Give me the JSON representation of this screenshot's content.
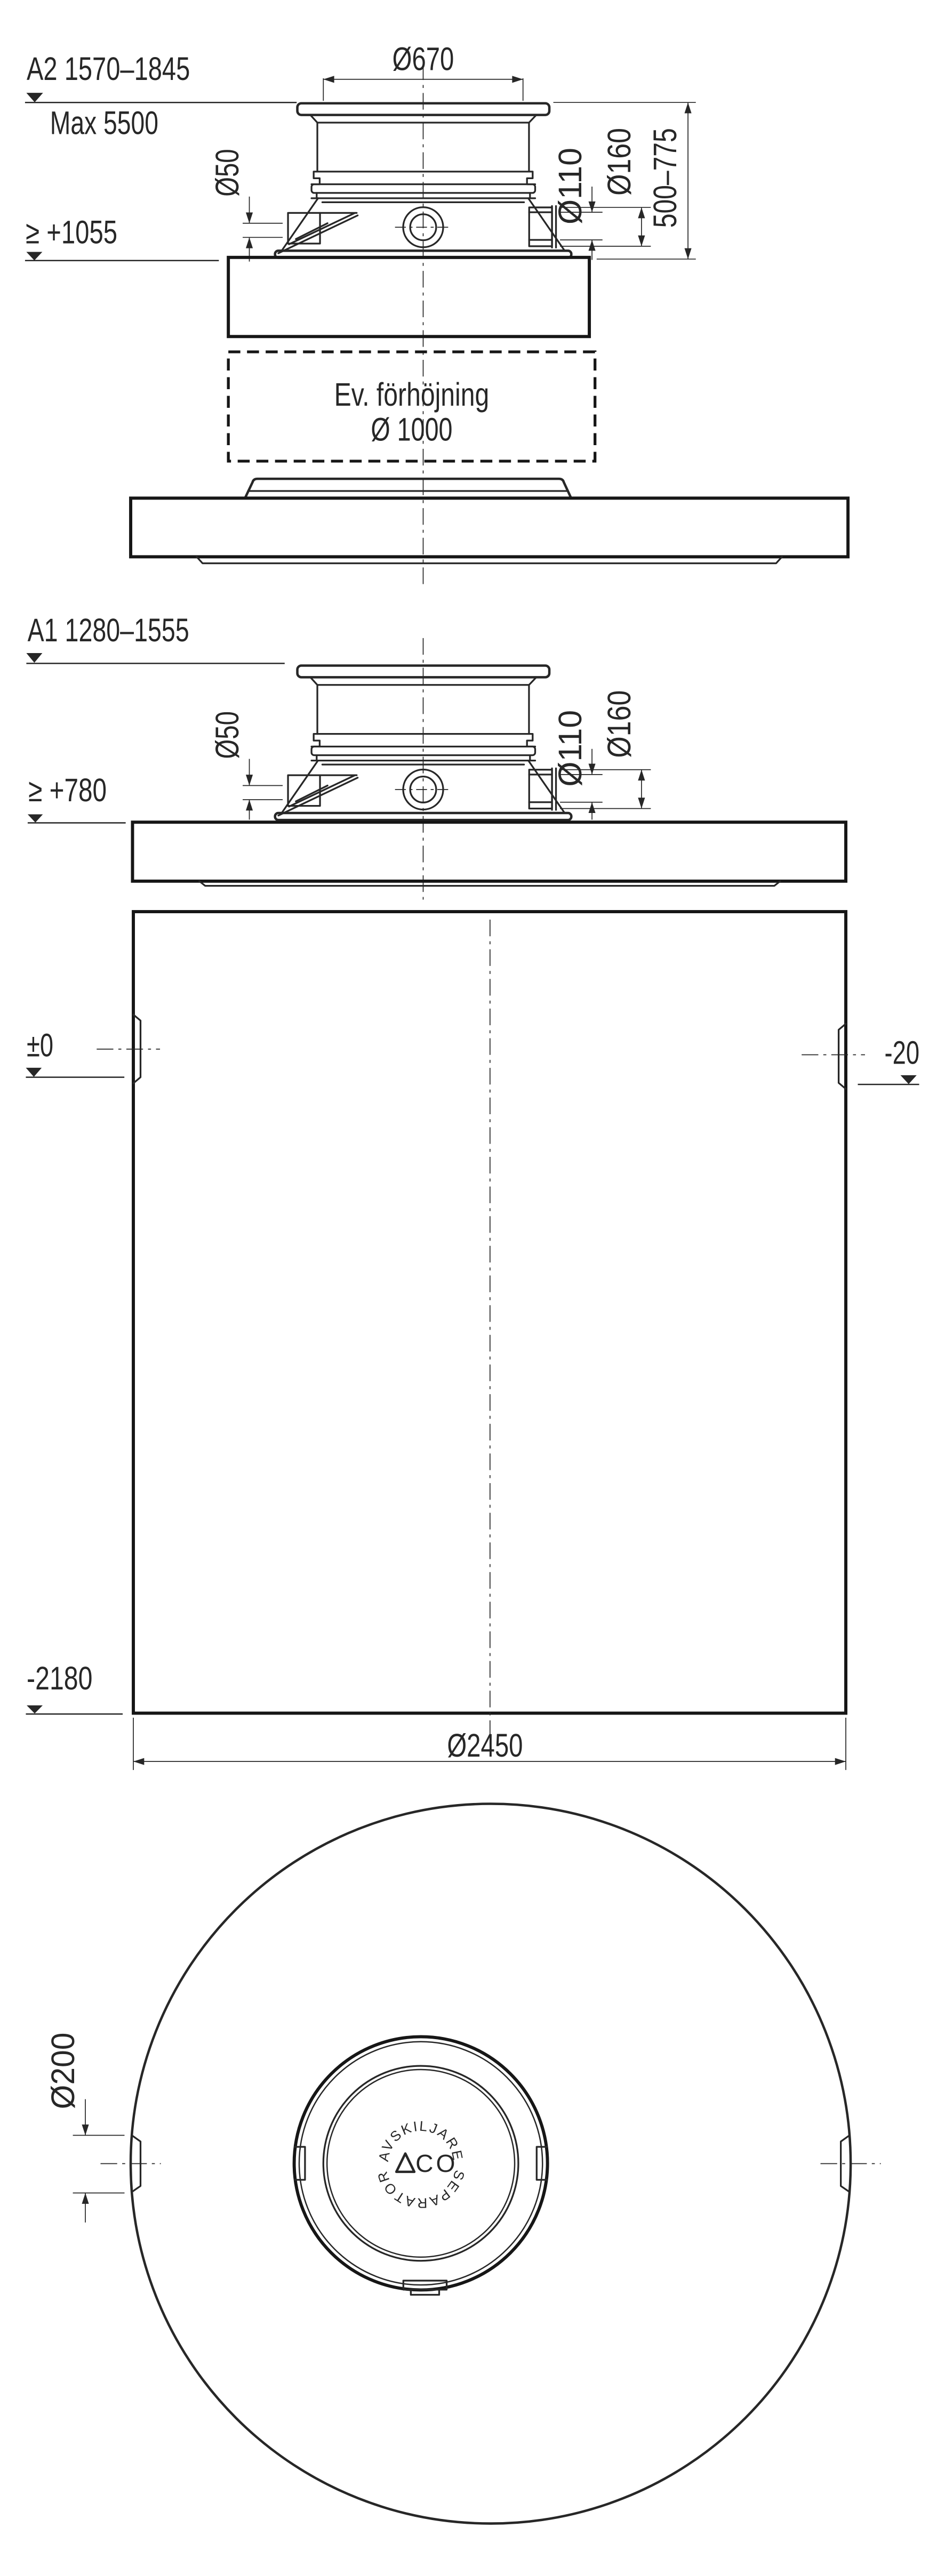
{
  "a2": {
    "label": "A2 1570–1845",
    "max_depth": "Max 5500",
    "cover_dia": "Ø670",
    "vent_dia": "Ø50",
    "outlet_inner_dia": "Ø110",
    "outlet_outer_dia": "Ø160",
    "adjust_range": "500–775",
    "invert_level": "≥ +1055",
    "extension_note": "Ev. förhöjning",
    "extension_dia": "Ø 1000"
  },
  "a1": {
    "label": "A1 1280–1555",
    "invert_level": "≥ +780",
    "vent_dia": "Ø50",
    "outlet_inner_dia": "Ø110",
    "outlet_outer_dia": "Ø160",
    "inlet_level": "±0",
    "outlet_level": "-20",
    "bottom_level": "-2180",
    "tank_dia": "Ø2450"
  },
  "top_view": {
    "socket_dia": "Ø200",
    "ring_text_top": "AVSKILJARE",
    "ring_text_bottom": "SEPARATOR",
    "logo_text": "CO",
    "logo_mark_icon": "aco-triangle"
  },
  "colors": {
    "line": "#272727",
    "heavy": "#161616",
    "bg": "#ffffff"
  }
}
